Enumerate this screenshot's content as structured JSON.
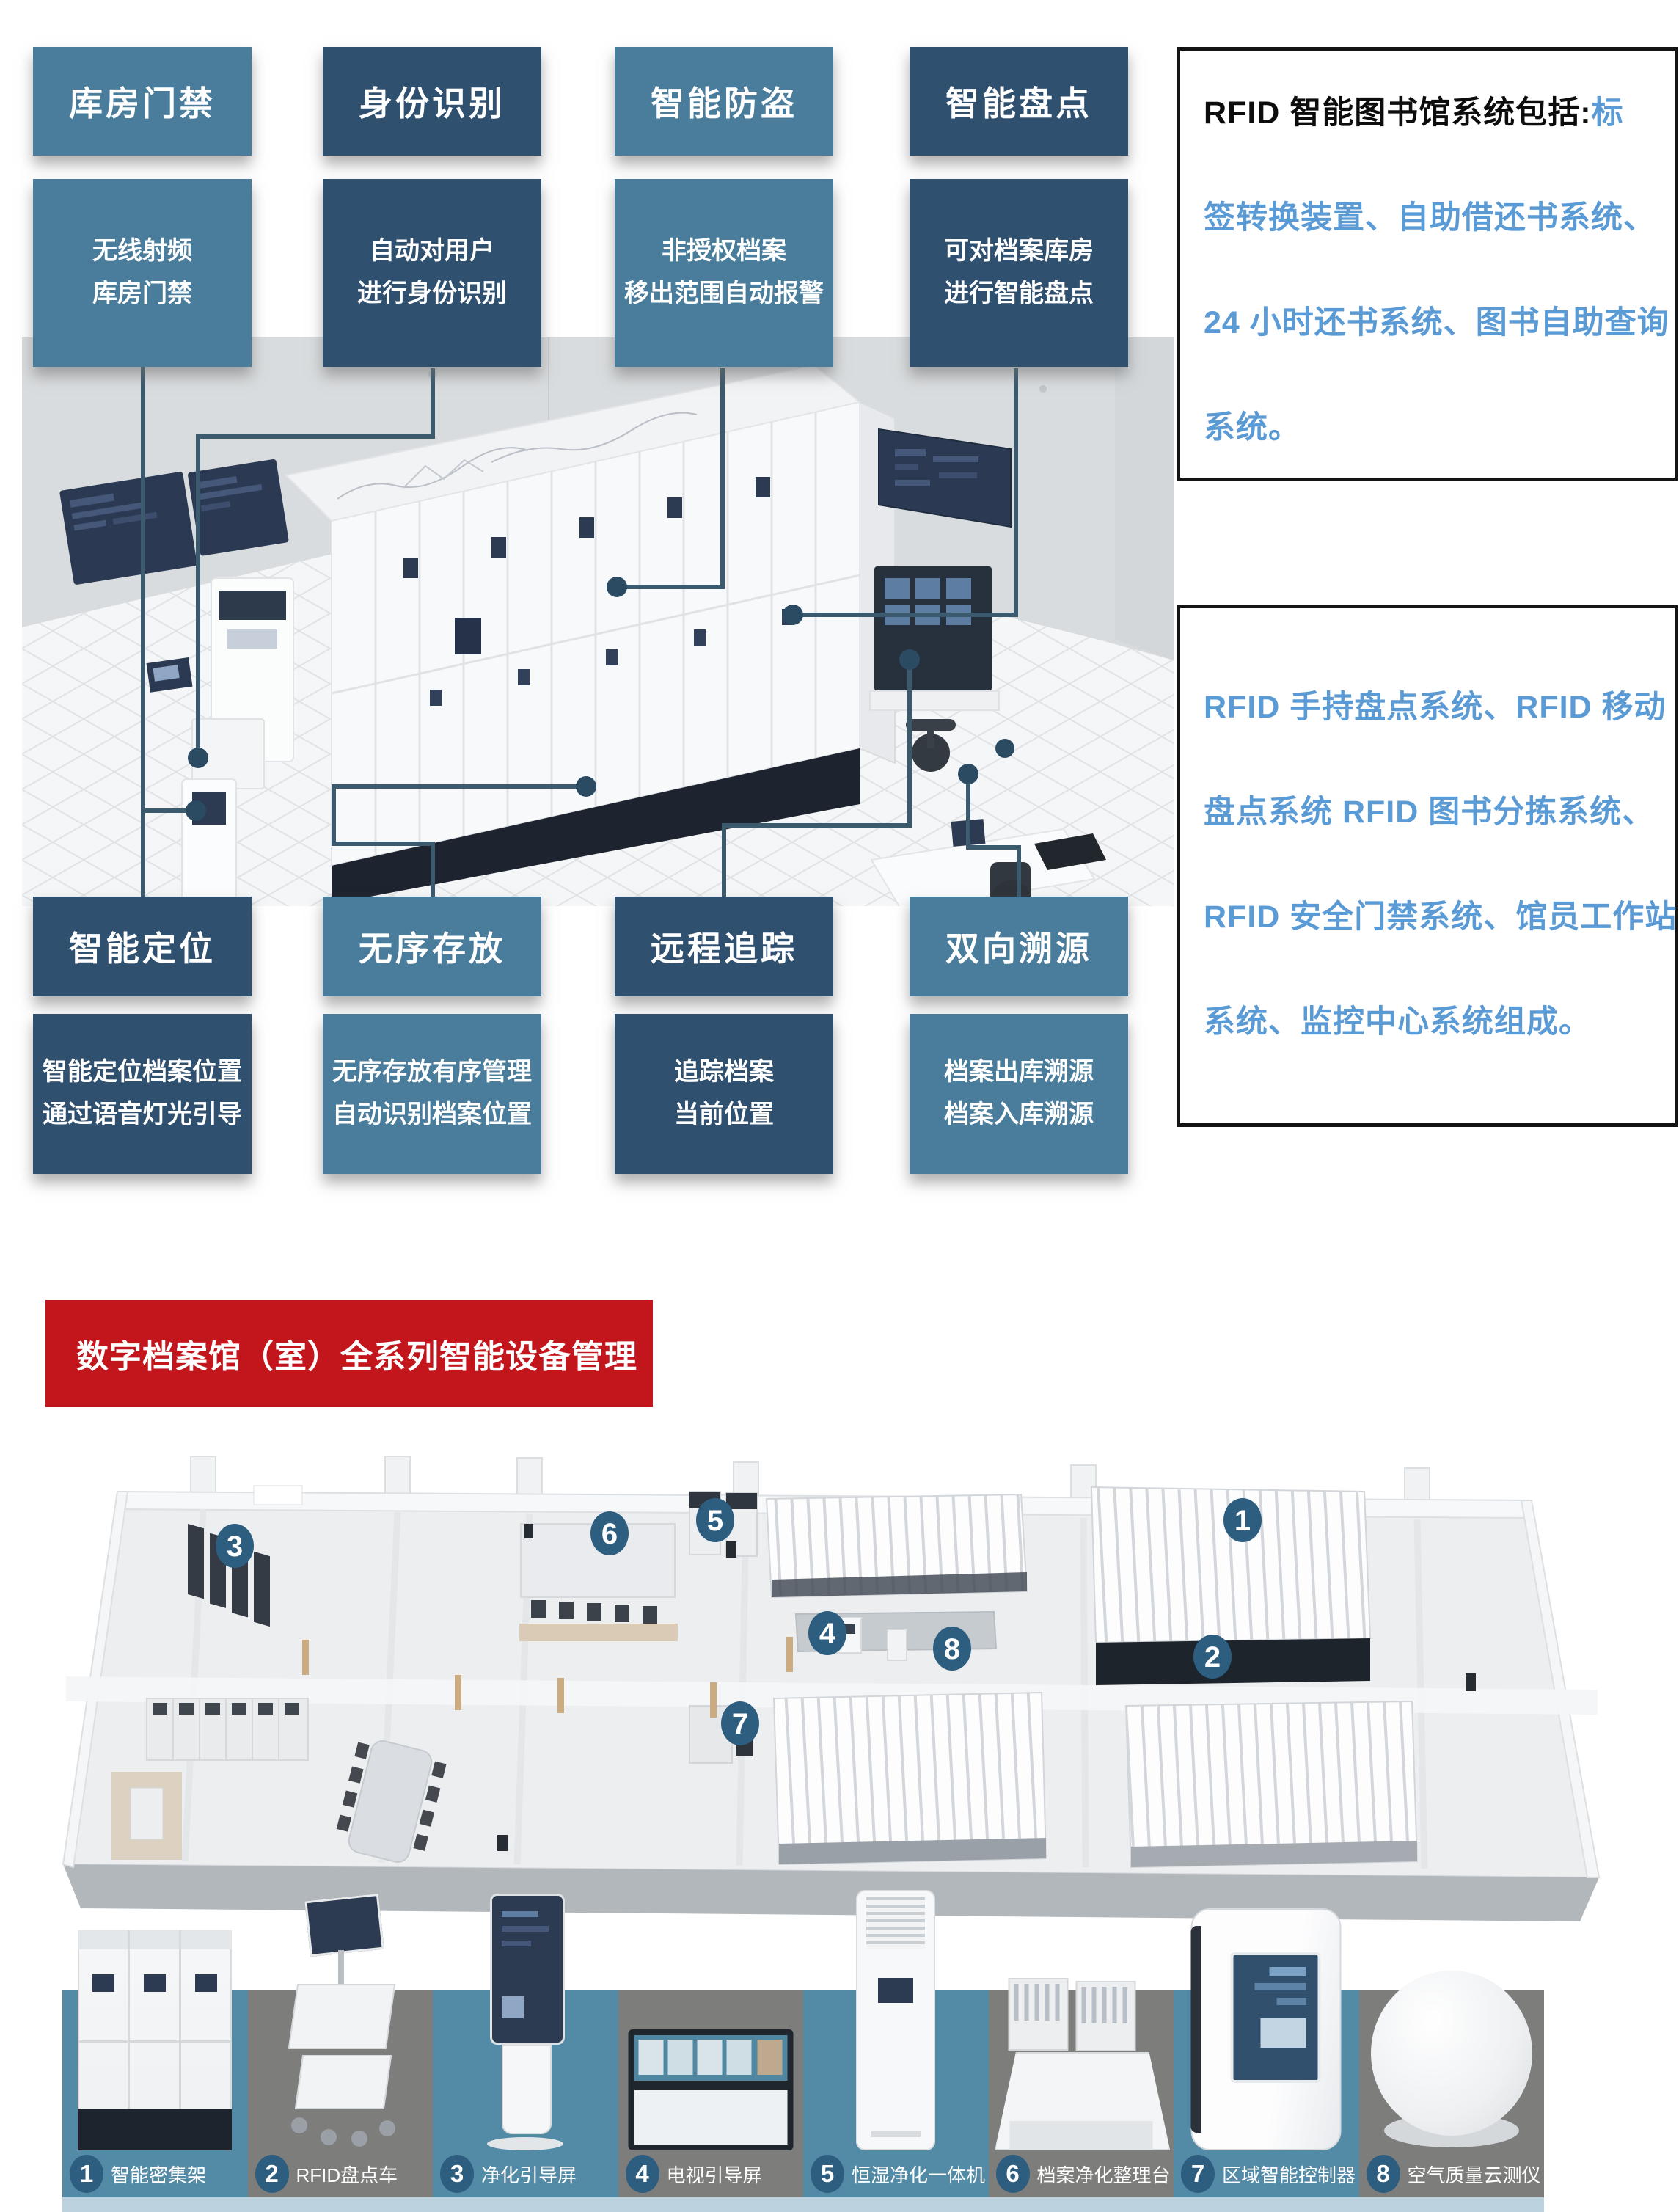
{
  "colors": {
    "teal_box": "#4a7d9b",
    "navy_box": "#30506f",
    "red_banner": "#c2151c",
    "blue_text": "#5b9bd5",
    "badge_blue": "#2d5e80",
    "strip_teal": "#538aa5",
    "strip_gray": "#7d7d7b",
    "strip_bottom_bar": "#bcd3df",
    "connector": "#3b5a6d"
  },
  "features_top": [
    {
      "title": "库房门禁",
      "lines": [
        "无线射频",
        "库房门禁"
      ]
    },
    {
      "title": "身份识别",
      "lines": [
        "自动对用户",
        "进行身份识别"
      ]
    },
    {
      "title": "智能防盗",
      "lines": [
        "非授权档案",
        "移出范围自动报警"
      ]
    },
    {
      "title": "智能盘点",
      "lines": [
        "可对档案库房",
        "进行智能盘点"
      ]
    }
  ],
  "features_bottom": [
    {
      "title": "智能定位",
      "lines": [
        "智能定位档案位置",
        "通过语音灯光引导"
      ]
    },
    {
      "title": "无序存放",
      "lines": [
        "无序存放有序管理",
        "自动识别档案位置"
      ]
    },
    {
      "title": "远程追踪",
      "lines": [
        "追踪档案",
        "当前位置"
      ]
    },
    {
      "title": "双向溯源",
      "lines": [
        "档案出库溯源",
        "档案入库溯源"
      ]
    }
  ],
  "info_box_1": {
    "lead_black": "RFID 智能图书馆系统包括:",
    "lead_blue": "标",
    "lines": [
      "签转换装置、自助借还书系统、",
      "24 小时还书系统、图书自助查询",
      "系统。"
    ]
  },
  "info_box_2": {
    "lines": [
      "RFID 手持盘点系统、RFID 移动",
      "盘点系统 RFID 图书分拣系统、",
      "RFID 安全门禁系统、馆员工作站",
      "系统、监控中心系统组成。"
    ]
  },
  "banner": {
    "title": "数字档案馆（室）全系列智能设备管理"
  },
  "floorplan": {
    "markers": [
      "1",
      "2",
      "3",
      "4",
      "5",
      "6",
      "7",
      "8"
    ]
  },
  "equipment": [
    {
      "num": "1",
      "name": "智能密集架"
    },
    {
      "num": "2",
      "name": "RFID盘点车"
    },
    {
      "num": "3",
      "name": "净化引导屏"
    },
    {
      "num": "4",
      "name": "电视引导屏"
    },
    {
      "num": "5",
      "name": "恒湿净化一体机"
    },
    {
      "num": "6",
      "name": "档案净化整理台"
    },
    {
      "num": "7",
      "name": "区域智能控制器"
    },
    {
      "num": "8",
      "name": "空气质量云测仪"
    }
  ]
}
